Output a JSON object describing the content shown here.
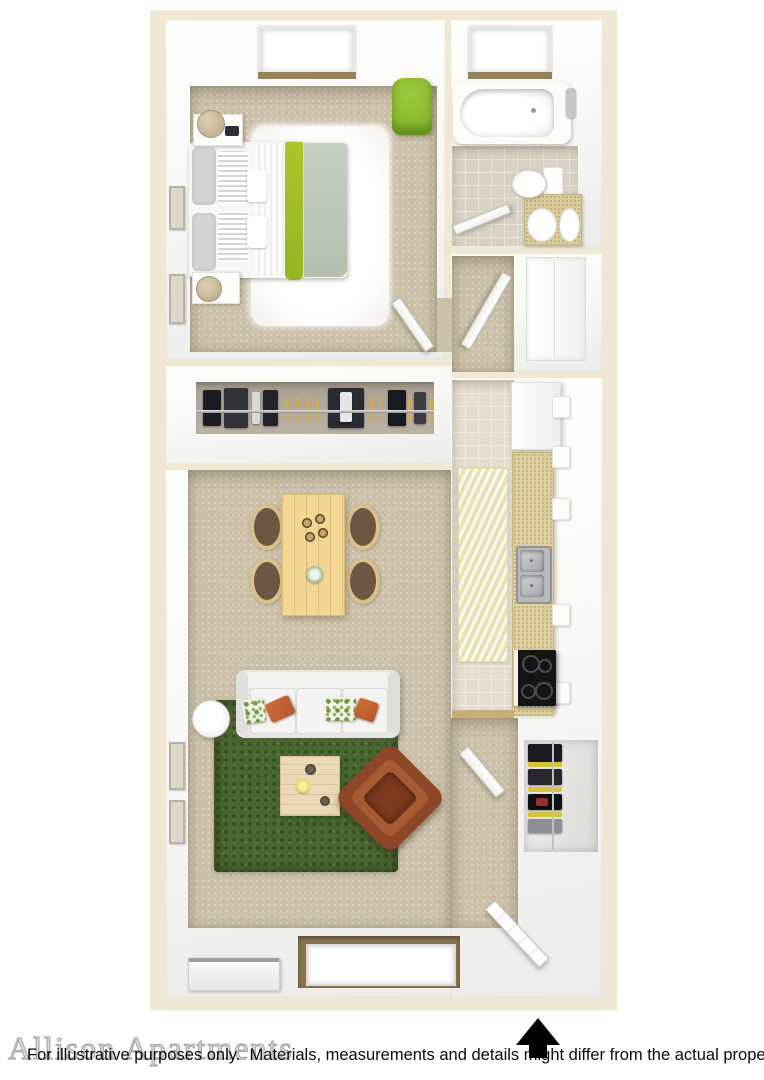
{
  "footer": {
    "watermark": "Allison Apartments",
    "disclaimer": "For illustrative purposes only.  Materials, measurements and details might differ from the actual property.",
    "north_arrow_icon": "north-arrow-up"
  },
  "palette": {
    "plate_cream": "#efe8d2",
    "wall_white": "#f6f6f4",
    "carpet_beige": "#cbc1a9",
    "bath_tile": "#d8d2c4",
    "kitchen_tile": "#e3ddd0",
    "closet_floor": "#b6aea0",
    "accent_green_chair": "#8cbb2f",
    "throw_green": "#a3c22c",
    "sage_blanket": "#c2cbbb",
    "shag_rug_green": "#4a6831",
    "wood_light": "#f2d694",
    "counter_speckle": "#dccf9f",
    "leather_brown": "#8f4627",
    "runner_yellow": "#f1eac6",
    "arrow_black": "#000000"
  },
  "scene": {
    "type": "3d-floor-plan",
    "items": [
      "bedroom-bed",
      "bedroom-nightstands",
      "bedroom-table-lamps",
      "white-shag-rug",
      "green-accent-chair",
      "bedroom-window",
      "framed-wall-art",
      "bathtub",
      "bathroom-window",
      "toilet",
      "vanity-sink",
      "bathroom-tile-floor",
      "hallway-doors",
      "pantry-doors",
      "hanging-closet-clothes",
      "refrigerator",
      "kitchen-counter",
      "double-sink",
      "range-stove",
      "kitchen-runner-rug",
      "dining-table",
      "dining-chairs",
      "sofa",
      "throw-pillows",
      "round-floor-lamp",
      "green-shag-rug",
      "coffee-table",
      "leather-armchair",
      "entry-closet-clothes",
      "entry-door",
      "living-room-window",
      "wall-unit"
    ]
  }
}
